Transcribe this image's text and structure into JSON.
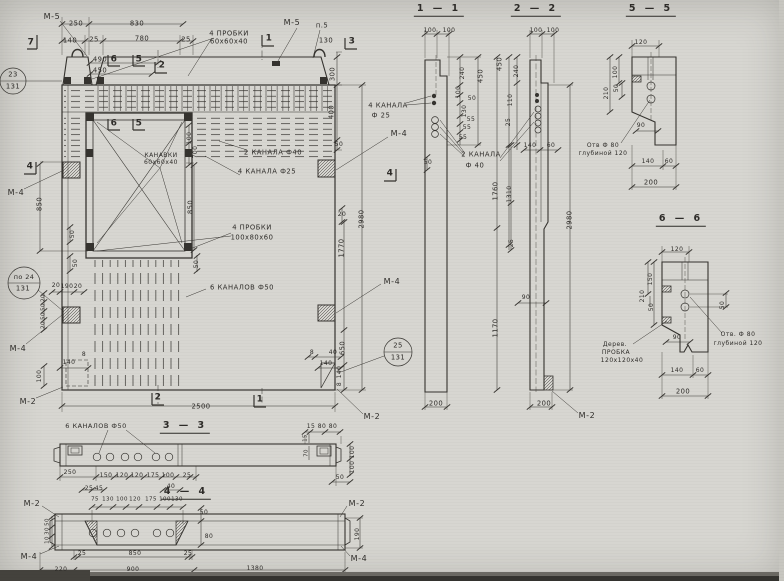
{
  "colors": {
    "paper": "#d7d6d1",
    "ink": "#35332f"
  },
  "labels": [
    {
      "t": "М-5",
      "x": 52,
      "y": 17,
      "c": "ml"
    },
    {
      "t": "250",
      "x": 76,
      "y": 24
    },
    {
      "t": "830",
      "x": 137,
      "y": 24
    },
    {
      "t": "140",
      "x": 70,
      "y": 41
    },
    {
      "t": "25",
      "x": 94,
      "y": 40
    },
    {
      "t": "780",
      "x": 142,
      "y": 39
    },
    {
      "t": "25",
      "x": 186,
      "y": 40
    },
    {
      "t": "4 ПРОБКИ",
      "x": 229,
      "y": 34,
      "c": "ann"
    },
    {
      "t": "60х60х40",
      "x": 229,
      "y": 42,
      "c": "ann"
    },
    {
      "t": "490",
      "x": 100,
      "y": 60
    },
    {
      "t": "450",
      "x": 100,
      "y": 71
    },
    {
      "t": "23",
      "x": 13,
      "y": 75
    },
    {
      "t": "131",
      "x": 13,
      "y": 87
    },
    {
      "t": "7",
      "x": 31,
      "y": 43,
      "c": "mark"
    },
    {
      "t": "6",
      "x": 114,
      "y": 60,
      "c": "mark"
    },
    {
      "t": "5",
      "x": 139,
      "y": 60,
      "c": "mark"
    },
    {
      "t": "2",
      "x": 162,
      "y": 66,
      "c": "mark"
    },
    {
      "t": "1",
      "x": 269,
      "y": 39,
      "c": "mark"
    },
    {
      "t": "М-5",
      "x": 292,
      "y": 23,
      "c": "ml"
    },
    {
      "t": "п.5",
      "x": 322,
      "y": 26
    },
    {
      "t": "130",
      "x": 326,
      "y": 41
    },
    {
      "t": "3",
      "x": 352,
      "y": 42,
      "c": "mark"
    },
    {
      "t": "6",
      "x": 114,
      "y": 124,
      "c": "mark"
    },
    {
      "t": "5",
      "x": 139,
      "y": 124,
      "c": "mark"
    },
    {
      "t": "КАНАВКИ",
      "x": 161,
      "y": 156,
      "c": "ann",
      "s": 6
    },
    {
      "t": "60х60х40",
      "x": 161,
      "y": 163,
      "c": "ann",
      "s": 6
    },
    {
      "t": "100",
      "x": 190,
      "y": 138,
      "r": -90,
      "s": 6
    },
    {
      "t": "700",
      "x": 196,
      "y": 152,
      "r": -90,
      "s": 6
    },
    {
      "t": "2 КАНАЛА Ф40",
      "x": 273,
      "y": 153,
      "c": "ann"
    },
    {
      "t": "4 КАНАЛА Ф25",
      "x": 267,
      "y": 172,
      "c": "ann"
    },
    {
      "t": "850",
      "x": 40,
      "y": 204,
      "r": -90
    },
    {
      "t": "50",
      "x": 73,
      "y": 234,
      "r": -90,
      "s": 6
    },
    {
      "t": "50",
      "x": 76,
      "y": 263,
      "r": -90,
      "s": 6
    },
    {
      "t": "850",
      "x": 191,
      "y": 207,
      "r": -90
    },
    {
      "t": "50",
      "x": 197,
      "y": 264,
      "r": -90,
      "s": 6
    },
    {
      "t": "4",
      "x": 30,
      "y": 167,
      "c": "mark"
    },
    {
      "t": "М-4",
      "x": 16,
      "y": 193,
      "c": "ml"
    },
    {
      "t": "по 24",
      "x": 24,
      "y": 277,
      "s": 6.5
    },
    {
      "t": "131",
      "x": 23,
      "y": 289
    },
    {
      "t": "20",
      "x": 56,
      "y": 286,
      "s": 6
    },
    {
      "t": "190",
      "x": 67,
      "y": 287,
      "s": 6
    },
    {
      "t": "20",
      "x": 78,
      "y": 287,
      "s": 6
    },
    {
      "t": "20",
      "x": 44,
      "y": 298,
      "r": -90,
      "s": 5.5
    },
    {
      "t": "50",
      "x": 44,
      "y": 307,
      "r": -90,
      "s": 5.5
    },
    {
      "t": "50",
      "x": 44,
      "y": 316,
      "r": -90,
      "s": 5.5
    },
    {
      "t": "20",
      "x": 44,
      "y": 325,
      "r": -90,
      "s": 5.5
    },
    {
      "t": "М-4",
      "x": 18,
      "y": 349,
      "c": "ml"
    },
    {
      "t": "8",
      "x": 84,
      "y": 355,
      "s": 6
    },
    {
      "t": "140",
      "x": 69,
      "y": 363,
      "s": 6
    },
    {
      "t": "100",
      "x": 40,
      "y": 376,
      "r": -90,
      "s": 6
    },
    {
      "t": "М-2",
      "x": 28,
      "y": 402,
      "c": "ml"
    },
    {
      "t": "4 ПРОБКИ",
      "x": 252,
      "y": 228,
      "c": "ann"
    },
    {
      "t": "100х80х60",
      "x": 252,
      "y": 238,
      "c": "ann"
    },
    {
      "t": "6 КАНАЛОВ Ф50",
      "x": 242,
      "y": 288,
      "c": "ann"
    },
    {
      "t": "300",
      "x": 333,
      "y": 74,
      "r": -90
    },
    {
      "t": "400",
      "x": 332,
      "y": 112,
      "r": -90
    },
    {
      "t": "50",
      "x": 339,
      "y": 145,
      "s": 6
    },
    {
      "t": "20",
      "x": 342,
      "y": 215,
      "s": 6
    },
    {
      "t": "2980",
      "x": 362,
      "y": 219,
      "r": -90
    },
    {
      "t": "1770",
      "x": 342,
      "y": 248,
      "r": -90
    },
    {
      "t": "650",
      "x": 343,
      "y": 348,
      "r": -90
    },
    {
      "t": "М-4",
      "x": 399,
      "y": 134,
      "c": "ml"
    },
    {
      "t": "4",
      "x": 390,
      "y": 174,
      "c": "mark"
    },
    {
      "t": "М-4",
      "x": 392,
      "y": 282,
      "c": "ml"
    },
    {
      "t": "25",
      "x": 398,
      "y": 346
    },
    {
      "t": "131",
      "x": 398,
      "y": 358
    },
    {
      "t": "8",
      "x": 312,
      "y": 353,
      "s": 6
    },
    {
      "t": "40",
      "x": 333,
      "y": 353,
      "s": 6
    },
    {
      "t": "140",
      "x": 326,
      "y": 364,
      "s": 6
    },
    {
      "t": "140",
      "x": 340,
      "y": 372,
      "r": -90,
      "s": 6
    },
    {
      "t": "8",
      "x": 340,
      "y": 384,
      "r": -90,
      "s": 6
    },
    {
      "t": "2",
      "x": 158,
      "y": 398,
      "c": "mark"
    },
    {
      "t": "1",
      "x": 260,
      "y": 400,
      "c": "mark"
    },
    {
      "t": "2500",
      "x": 201,
      "y": 407
    },
    {
      "t": "М-2",
      "x": 372,
      "y": 417,
      "c": "ml"
    },
    {
      "t": "1 — 1",
      "x": 439,
      "y": 10,
      "c": "ttl"
    },
    {
      "t": "100",
      "x": 430,
      "y": 31,
      "s": 6
    },
    {
      "t": "100",
      "x": 449,
      "y": 31,
      "s": 6
    },
    {
      "t": "4 КАНАЛА",
      "x": 388,
      "y": 106,
      "c": "ann"
    },
    {
      "t": "Ф 25",
      "x": 381,
      "y": 116,
      "c": "ann"
    },
    {
      "t": "2 КАНАЛА",
      "x": 481,
      "y": 155,
      "c": "ann"
    },
    {
      "t": "Ф 40",
      "x": 475,
      "y": 166,
      "c": "ann"
    },
    {
      "t": "240",
      "x": 463,
      "y": 73,
      "r": -90,
      "s": 6
    },
    {
      "t": "450",
      "x": 481,
      "y": 76,
      "r": -90
    },
    {
      "t": "100",
      "x": 459,
      "y": 92,
      "r": -90,
      "s": 6
    },
    {
      "t": "50",
      "x": 472,
      "y": 99,
      "s": 6
    },
    {
      "t": "130",
      "x": 465,
      "y": 111,
      "r": -90,
      "s": 6
    },
    {
      "t": "55",
      "x": 471,
      "y": 120,
      "s": 6
    },
    {
      "t": "55",
      "x": 467,
      "y": 128,
      "s": 6
    },
    {
      "t": "55",
      "x": 463,
      "y": 138,
      "s": 6
    },
    {
      "t": "50",
      "x": 428,
      "y": 163,
      "s": 6
    },
    {
      "t": "200",
      "x": 436,
      "y": 404
    },
    {
      "t": "2 — 2",
      "x": 536,
      "y": 10,
      "c": "ttl"
    },
    {
      "t": "100",
      "x": 536,
      "y": 31,
      "s": 6
    },
    {
      "t": "100",
      "x": 553,
      "y": 31,
      "s": 6
    },
    {
      "t": "450",
      "x": 500,
      "y": 64,
      "r": -90
    },
    {
      "t": "240",
      "x": 517,
      "y": 71,
      "r": -90,
      "s": 6
    },
    {
      "t": "110",
      "x": 511,
      "y": 100,
      "r": -90,
      "s": 6
    },
    {
      "t": "25",
      "x": 509,
      "y": 122,
      "r": -90,
      "s": 6
    },
    {
      "t": "140",
      "x": 530,
      "y": 146,
      "s": 6
    },
    {
      "t": "60",
      "x": 551,
      "y": 146,
      "s": 6
    },
    {
      "t": "1760",
      "x": 496,
      "y": 191,
      "r": -90
    },
    {
      "t": "1310",
      "x": 510,
      "y": 194,
      "r": -90,
      "s": 6
    },
    {
      "t": "25",
      "x": 512,
      "y": 243,
      "r": -90,
      "s": 6
    },
    {
      "t": "90",
      "x": 526,
      "y": 298,
      "s": 6
    },
    {
      "t": "1170",
      "x": 496,
      "y": 328,
      "r": -90
    },
    {
      "t": "2980",
      "x": 570,
      "y": 220,
      "r": -90
    },
    {
      "t": "200",
      "x": 544,
      "y": 404
    },
    {
      "t": "М-2",
      "x": 587,
      "y": 416,
      "c": "ml"
    },
    {
      "t": "5 — 5",
      "x": 651,
      "y": 10,
      "c": "ttl"
    },
    {
      "t": "120",
      "x": 641,
      "y": 43,
      "s": 6
    },
    {
      "t": "100",
      "x": 616,
      "y": 72,
      "r": -90,
      "s": 6
    },
    {
      "t": "210",
      "x": 607,
      "y": 93,
      "r": -90,
      "s": 6
    },
    {
      "t": "50",
      "x": 617,
      "y": 88,
      "r": -90,
      "s": 6
    },
    {
      "t": "90",
      "x": 641,
      "y": 126,
      "s": 6
    },
    {
      "t": "Отв Ф 80",
      "x": 603,
      "y": 146,
      "c": "ann",
      "s": 6
    },
    {
      "t": "глубиной 120",
      "x": 603,
      "y": 154,
      "c": "ann",
      "s": 6
    },
    {
      "t": "140",
      "x": 648,
      "y": 162,
      "s": 6
    },
    {
      "t": "60",
      "x": 669,
      "y": 162,
      "s": 6
    },
    {
      "t": "200",
      "x": 651,
      "y": 183
    },
    {
      "t": "6 — 6",
      "x": 681,
      "y": 220,
      "c": "ttl"
    },
    {
      "t": "120",
      "x": 677,
      "y": 250,
      "s": 6
    },
    {
      "t": "150",
      "x": 651,
      "y": 279,
      "r": -90,
      "s": 6
    },
    {
      "t": "210",
      "x": 643,
      "y": 296,
      "r": -90,
      "s": 6
    },
    {
      "t": "50",
      "x": 652,
      "y": 307,
      "r": -90,
      "s": 6
    },
    {
      "t": "50",
      "x": 723,
      "y": 305,
      "r": -90,
      "s": 6
    },
    {
      "t": "90",
      "x": 677,
      "y": 338,
      "s": 6
    },
    {
      "t": "Дерев.",
      "x": 615,
      "y": 345,
      "c": "ann",
      "s": 6
    },
    {
      "t": "ПРОБКА",
      "x": 616,
      "y": 353,
      "c": "ann",
      "s": 6
    },
    {
      "t": "120х120х40",
      "x": 622,
      "y": 361,
      "c": "ann",
      "s": 6
    },
    {
      "t": "Отв. Ф 80",
      "x": 738,
      "y": 335,
      "c": "ann",
      "s": 6
    },
    {
      "t": "глубиной 120",
      "x": 738,
      "y": 344,
      "c": "ann",
      "s": 6
    },
    {
      "t": "140",
      "x": 677,
      "y": 371,
      "s": 6
    },
    {
      "t": "60",
      "x": 700,
      "y": 371,
      "s": 6
    },
    {
      "t": "200",
      "x": 683,
      "y": 392
    },
    {
      "t": "3 — 3",
      "x": 185,
      "y": 427,
      "c": "ttl"
    },
    {
      "t": "6 КАНАЛОВ Ф50",
      "x": 96,
      "y": 426,
      "c": "ann",
      "s": 6.5
    },
    {
      "t": "250",
      "x": 70,
      "y": 473,
      "s": 6
    },
    {
      "t": "150",
      "x": 106,
      "y": 476,
      "s": 6
    },
    {
      "t": "120",
      "x": 122,
      "y": 476,
      "s": 6
    },
    {
      "t": "120",
      "x": 137,
      "y": 476,
      "s": 6
    },
    {
      "t": "175",
      "x": 153,
      "y": 476,
      "s": 6
    },
    {
      "t": "100",
      "x": 168,
      "y": 476,
      "s": 6
    },
    {
      "t": "25",
      "x": 187,
      "y": 476,
      "s": 6
    },
    {
      "t": "25",
      "x": 89,
      "y": 489,
      "s": 6
    },
    {
      "t": "45",
      "x": 99,
      "y": 489,
      "s": 6
    },
    {
      "t": "40",
      "x": 171,
      "y": 487,
      "s": 6
    },
    {
      "t": "15",
      "x": 311,
      "y": 427,
      "s": 6
    },
    {
      "t": "80",
      "x": 322,
      "y": 427,
      "s": 6
    },
    {
      "t": "80",
      "x": 333,
      "y": 427,
      "s": 6
    },
    {
      "t": "15",
      "x": 306,
      "y": 438,
      "r": -90,
      "s": 5.5
    },
    {
      "t": "70",
      "x": 307,
      "y": 453,
      "r": -90,
      "s": 5.5
    },
    {
      "t": "100",
      "x": 353,
      "y": 452,
      "r": -90,
      "s": 6
    },
    {
      "t": "100",
      "x": 353,
      "y": 467,
      "r": -90,
      "s": 6
    },
    {
      "t": "50",
      "x": 340,
      "y": 478,
      "s": 6
    },
    {
      "t": "4 — 4",
      "x": 186,
      "y": 493,
      "c": "ttl"
    },
    {
      "t": "М-2",
      "x": 32,
      "y": 504,
      "c": "ml"
    },
    {
      "t": "М-2",
      "x": 357,
      "y": 504,
      "c": "ml"
    },
    {
      "t": "М-4",
      "x": 29,
      "y": 557,
      "c": "ml"
    },
    {
      "t": "М-4",
      "x": 359,
      "y": 559,
      "c": "ml"
    },
    {
      "t": "75",
      "x": 95,
      "y": 500,
      "s": 5.5
    },
    {
      "t": "130",
      "x": 108,
      "y": 500,
      "s": 5.5
    },
    {
      "t": "100",
      "x": 122,
      "y": 500,
      "s": 5.5
    },
    {
      "t": "120",
      "x": 135,
      "y": 500,
      "s": 5.5
    },
    {
      "t": "175",
      "x": 151,
      "y": 500,
      "s": 5.5
    },
    {
      "t": "100",
      "x": 165,
      "y": 500,
      "s": 5.5
    },
    {
      "t": "130",
      "x": 177,
      "y": 500,
      "s": 5.5
    },
    {
      "t": "50",
      "x": 48,
      "y": 522,
      "r": -90,
      "s": 5.5
    },
    {
      "t": "30",
      "x": 48,
      "y": 531,
      "r": -90,
      "s": 5.5
    },
    {
      "t": "10",
      "x": 48,
      "y": 540,
      "r": -90,
      "s": 5.5
    },
    {
      "t": "50",
      "x": 204,
      "y": 513,
      "s": 6
    },
    {
      "t": "80",
      "x": 209,
      "y": 537,
      "s": 6
    },
    {
      "t": "25",
      "x": 82,
      "y": 554,
      "s": 6
    },
    {
      "t": "850",
      "x": 135,
      "y": 554,
      "s": 6
    },
    {
      "t": "25",
      "x": 188,
      "y": 554,
      "s": 6
    },
    {
      "t": "220",
      "x": 61,
      "y": 570,
      "s": 6
    },
    {
      "t": "900",
      "x": 133,
      "y": 570,
      "s": 6
    },
    {
      "t": "1380",
      "x": 255,
      "y": 569,
      "s": 6
    },
    {
      "t": "190",
      "x": 358,
      "y": 534,
      "r": -90,
      "s": 6
    }
  ]
}
